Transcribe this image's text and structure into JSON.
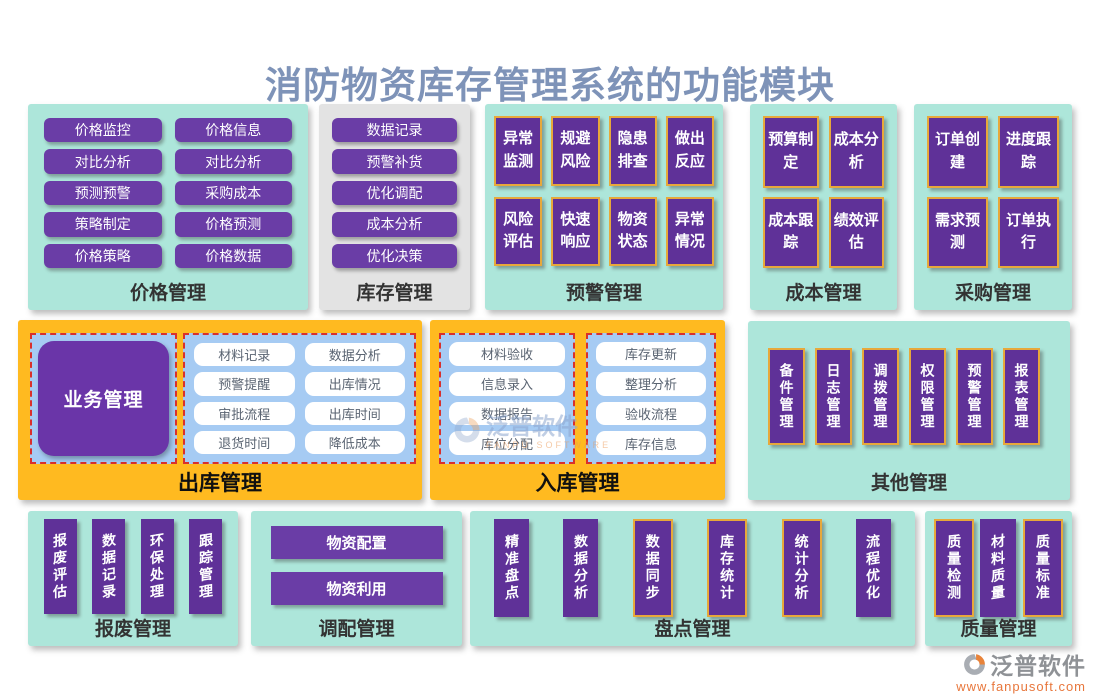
{
  "title": "消防物资库存管理系统的功能模块",
  "colors": {
    "title": "#7e93b8",
    "panel_teal": "#ade6da",
    "panel_gray": "#e3e3e3",
    "panel_orange": "#ffba20",
    "button_purple": "#6a3da6",
    "box_deep_purple": "#5f3198",
    "box_yellow_border": "#e7a83b",
    "group_blue": "#a6cbf3",
    "group_red_dashed_border": "#d9302c",
    "url_orange": "#e8773c"
  },
  "panels": {
    "price": {
      "label": "价格管理",
      "items": [
        "价格监控",
        "价格信息",
        "对比分析",
        "对比分析",
        "预测预警",
        "采购成本",
        "策略制定",
        "价格预测",
        "价格策略",
        "价格数据"
      ]
    },
    "inventory": {
      "label": "库存管理",
      "items": [
        "数据记录",
        "预警补货",
        "优化调配",
        "成本分析",
        "优化决策"
      ]
    },
    "warning": {
      "label": "预警管理",
      "items": [
        "异常监测",
        "规避风险",
        "隐患排查",
        "做出反应",
        "风险评估",
        "快速响应",
        "物资状态",
        "异常情况"
      ]
    },
    "cost": {
      "label": "成本管理",
      "items": [
        "预算制定",
        "成本分析",
        "成本跟踪",
        "绩效评估"
      ]
    },
    "procurement": {
      "label": "采购管理",
      "items": [
        "订单创建",
        "进度跟踪",
        "需求预测",
        "订单执行"
      ]
    },
    "outbound": {
      "label": "出库管理",
      "business": "业务管理",
      "items": [
        "材料记录",
        "数据分析",
        "预警提醒",
        "出库情况",
        "审批流程",
        "出库时间",
        "退货时间",
        "降低成本"
      ]
    },
    "inbound": {
      "label": "入库管理",
      "group1": [
        "材料验收",
        "信息录入",
        "数据报告",
        "库位分配"
      ],
      "group2": [
        "库存更新",
        "整理分析",
        "验收流程",
        "库存信息"
      ]
    },
    "other": {
      "label": "其他管理",
      "items": [
        "备件管理",
        "日志管理",
        "调拨管理",
        "权限管理",
        "预警管理",
        "报表管理"
      ]
    },
    "scrap": {
      "label": "报废管理",
      "items": [
        "报废评估",
        "数据记录",
        "环保处理",
        "跟踪管理"
      ]
    },
    "allocation": {
      "label": "调配管理",
      "items": [
        "物资配置",
        "物资利用"
      ]
    },
    "stocktake": {
      "label": "盘点管理",
      "items": [
        "精准盘点",
        "数据分析",
        "数据同步",
        "库存统计",
        "统计分析",
        "流程优化"
      ]
    },
    "quality": {
      "label": "质量管理",
      "items": [
        "质量检测",
        "材料质量",
        "质量标准"
      ]
    }
  },
  "watermark": {
    "name": "泛普软件",
    "sub": "FANPU SOFTWARE"
  },
  "logo": {
    "name": "泛普软件",
    "url": "www.fanpusoft.com"
  }
}
